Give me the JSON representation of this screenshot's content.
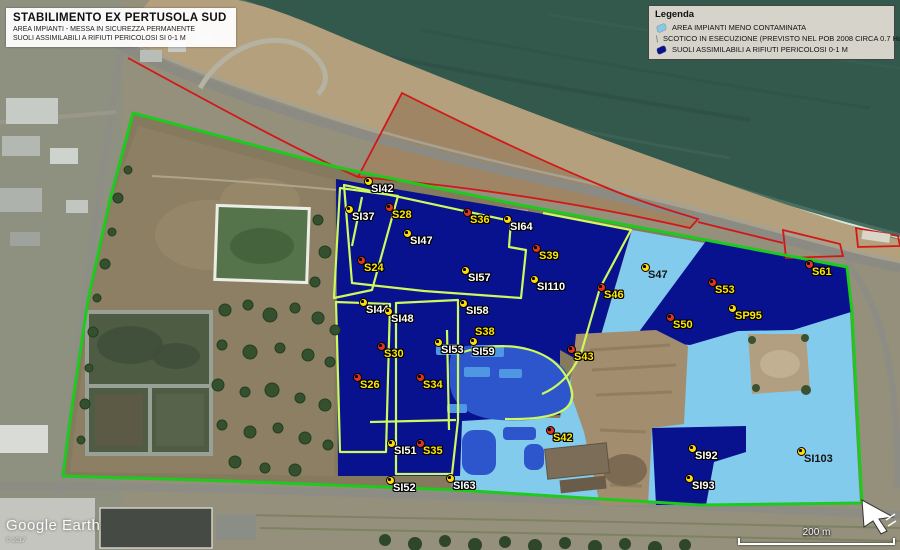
{
  "title_box": {
    "title": "STABILIMENTO EX PERTUSOLA SUD",
    "subtitle1": "AREA IMPIANTI - MESSA IN SICUREZZA PERMANENTE",
    "subtitle2": "SUOLI ASSIMILABILI A RIFIUTI PERICOLOSI SI 0-1 M"
  },
  "legend": {
    "title": "Legenda",
    "items": [
      {
        "label": "AREA IMPIANTI MENO CONTAMINATA",
        "color": "#82cbec"
      },
      {
        "label": "SCOTICO IN ESECUZIONE (PREVISTO NEL POB 2008 CIRCA 0.7 Ha)",
        "color": "#2d56cd"
      },
      {
        "label": "SUOLI ASSIMILABILI A RIFIUTI PERICOLOSI 0-1 M",
        "color": "#08128f"
      }
    ]
  },
  "map": {
    "attribution": "Google Earth",
    "copyright": "© 2017",
    "scale_label": "200 m",
    "zone_colors": {
      "hazardous_soil_navy": "#08128f",
      "less_contaminated_light_blue": "#82cbec",
      "scotico_medium_blue": "#2d56cd",
      "site_boundary_green": "#1dca1d",
      "parcel_outline_lime": "#cdf95c",
      "annotation_red": "#d31717"
    }
  },
  "points": [
    {
      "id": "SI42",
      "x": 368,
      "y": 181,
      "marker": "yellow",
      "label_color": "white"
    },
    {
      "id": "SI37",
      "x": 349,
      "y": 209,
      "marker": "yellow",
      "label_color": "white"
    },
    {
      "id": "S28",
      "x": 389,
      "y": 207,
      "marker": "red",
      "label_color": "yellow"
    },
    {
      "id": "S36",
      "x": 467,
      "y": 212,
      "marker": "red",
      "label_color": "yellow"
    },
    {
      "id": "SI64",
      "x": 507,
      "y": 219,
      "marker": "yellow",
      "label_color": "white"
    },
    {
      "id": "SI47",
      "x": 407,
      "y": 233,
      "marker": "yellow",
      "label_color": "white"
    },
    {
      "id": "S39",
      "x": 536,
      "y": 248,
      "marker": "red",
      "label_color": "yellow"
    },
    {
      "id": "S24",
      "x": 361,
      "y": 260,
      "marker": "red",
      "label_color": "yellow"
    },
    {
      "id": "SI57",
      "x": 465,
      "y": 270,
      "marker": "yellow",
      "label_color": "white"
    },
    {
      "id": "SI110",
      "x": 534,
      "y": 279,
      "marker": "yellow",
      "label_color": "white"
    },
    {
      "id": "S47",
      "x": 645,
      "y": 267,
      "marker": "yellow",
      "label_color": "black"
    },
    {
      "id": "S46",
      "x": 601,
      "y": 287,
      "marker": "red",
      "label_color": "yellow"
    },
    {
      "id": "S53",
      "x": 712,
      "y": 282,
      "marker": "red",
      "label_color": "yellow"
    },
    {
      "id": "S61",
      "x": 809,
      "y": 264,
      "marker": "red",
      "label_color": "yellow"
    },
    {
      "id": "S50",
      "x": 670,
      "y": 317,
      "marker": "red",
      "label_color": "yellow"
    },
    {
      "id": "SP95",
      "x": 732,
      "y": 308,
      "marker": "yellow",
      "label_color": "yellow"
    },
    {
      "id": "SI44",
      "x": 363,
      "y": 302,
      "marker": "yellow",
      "label_color": "white"
    },
    {
      "id": "SI48",
      "x": 388,
      "y": 311,
      "marker": "yellow",
      "label_color": "white"
    },
    {
      "id": "SI58",
      "x": 463,
      "y": 303,
      "marker": "yellow",
      "label_color": "white"
    },
    {
      "id": "S30",
      "x": 381,
      "y": 346,
      "marker": "red",
      "label_color": "yellow"
    },
    {
      "id": "SI53",
      "x": 438,
      "y": 342,
      "marker": "yellow",
      "label_color": "white"
    },
    {
      "id": "S38",
      "x": 473,
      "y": 341,
      "marker": "yellow",
      "label_color": "yellow",
      "lx": 2,
      "ly": -15
    },
    {
      "id": "SI59",
      "x": 472,
      "y": 346,
      "marker": "none",
      "label_color": "white",
      "lx": 0,
      "ly": 0
    },
    {
      "id": "S43",
      "x": 571,
      "y": 349,
      "marker": "red",
      "label_color": "yellow"
    },
    {
      "id": "S26",
      "x": 357,
      "y": 377,
      "marker": "red",
      "label_color": "yellow"
    },
    {
      "id": "S34",
      "x": 420,
      "y": 377,
      "marker": "red",
      "label_color": "yellow"
    },
    {
      "id": "S42",
      "x": 550,
      "y": 430,
      "marker": "red",
      "label_color": "yellow"
    },
    {
      "id": "SI51",
      "x": 391,
      "y": 443,
      "marker": "yellow",
      "label_color": "white"
    },
    {
      "id": "S35",
      "x": 420,
      "y": 443,
      "marker": "red",
      "label_color": "yellow"
    },
    {
      "id": "SI92",
      "x": 692,
      "y": 448,
      "marker": "yellow",
      "label_color": "white"
    },
    {
      "id": "SI93",
      "x": 689,
      "y": 478,
      "marker": "yellow",
      "label_color": "white"
    },
    {
      "id": "SI103",
      "x": 801,
      "y": 451,
      "marker": "yellow",
      "label_color": "black"
    },
    {
      "id": "SI52",
      "x": 390,
      "y": 480,
      "marker": "yellow",
      "label_color": "white"
    },
    {
      "id": "SI63",
      "x": 450,
      "y": 478,
      "marker": "yellow",
      "label_color": "white"
    }
  ]
}
